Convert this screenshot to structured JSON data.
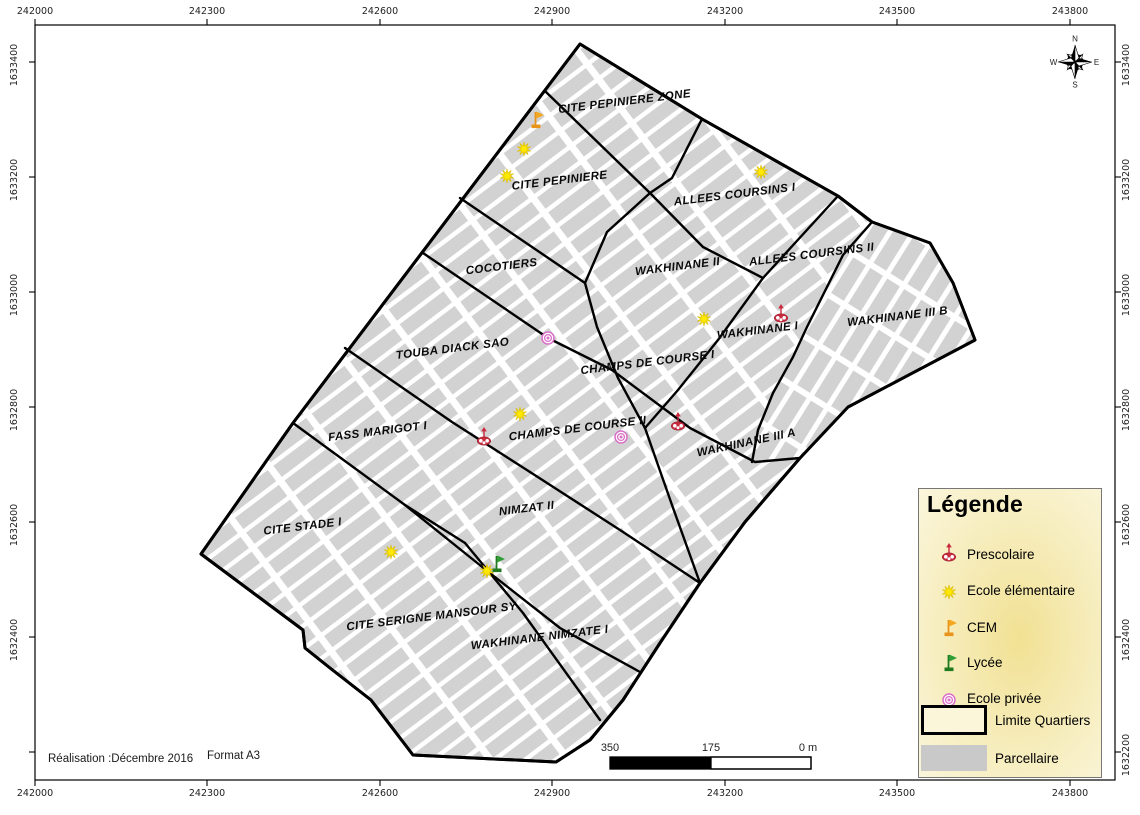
{
  "axes": {
    "top": [
      "242000",
      "242300",
      "242600",
      "242900",
      "243200",
      "243500",
      "243800"
    ],
    "bottom": [
      "242000",
      "242300",
      "242600",
      "242900",
      "243200",
      "243500",
      "243800"
    ],
    "left": [
      "1633400",
      "1633200",
      "1633000",
      "1632800",
      "1632600",
      "1632400"
    ],
    "right": [
      "1633400",
      "1633200",
      "1633000",
      "1632800",
      "1632600",
      "1632400",
      "1632200"
    ]
  },
  "regions": [
    {
      "label": "CITE PEPINIERE ZONE",
      "x": 625,
      "y": 105,
      "fs": 11.5,
      "rot": -7
    },
    {
      "label": "CITE PEPINIERE",
      "x": 560,
      "y": 184,
      "fs": 11.5,
      "rot": -7
    },
    {
      "label": "ALLEES COURSINS I",
      "x": 735,
      "y": 198,
      "fs": 11.5,
      "rot": -7
    },
    {
      "label": "ALLEES COURSINS II",
      "x": 812,
      "y": 258,
      "fs": 11.5,
      "rot": -7
    },
    {
      "label": "COCOTIERS",
      "x": 502,
      "y": 270,
      "fs": 11.5,
      "rot": -7
    },
    {
      "label": "WAKHINANE II",
      "x": 678,
      "y": 270,
      "fs": 11.5,
      "rot": -7
    },
    {
      "label": "WAKHINANE I",
      "x": 758,
      "y": 334,
      "fs": 11.5,
      "rot": -7
    },
    {
      "label": "WAKHINANE III B",
      "x": 898,
      "y": 320,
      "fs": 11.5,
      "rot": -7
    },
    {
      "label": "TOUBA DIACK SAO",
      "x": 453,
      "y": 352,
      "fs": 11.5,
      "rot": -7
    },
    {
      "label": "CHAMPS DE COURSE I",
      "x": 648,
      "y": 366,
      "fs": 11.5,
      "rot": -7
    },
    {
      "label": "CHAMPS DE COURSE II",
      "x": 578,
      "y": 432,
      "fs": 11.5,
      "rot": -7
    },
    {
      "label": "WAKHINANE III A",
      "x": 747,
      "y": 446,
      "fs": 11.5,
      "rot": -12
    },
    {
      "label": "FASS MARIGOT I",
      "x": 378,
      "y": 435,
      "fs": 11.5,
      "rot": -7
    },
    {
      "label": "NIMZAT II",
      "x": 527,
      "y": 512,
      "fs": 11.5,
      "rot": -7
    },
    {
      "label": "CITE STADE I",
      "x": 303,
      "y": 530,
      "fs": 11.5,
      "rot": -7
    },
    {
      "label": "CITE SERIGNE MANSOUR SY",
      "x": 432,
      "y": 620,
      "fs": 11.5,
      "rot": -7
    },
    {
      "label": "WAKHINANE NIMZATE I",
      "x": 540,
      "y": 641,
      "fs": 11.5,
      "rot": -7
    }
  ],
  "markers": [
    {
      "type": "cem",
      "x": 536,
      "y": 121
    },
    {
      "type": "ecole_elementaire",
      "x": 524,
      "y": 149
    },
    {
      "type": "ecole_elementaire",
      "x": 507,
      "y": 176
    },
    {
      "type": "ecole_elementaire",
      "x": 761,
      "y": 172
    },
    {
      "type": "ecole_elementaire",
      "x": 704,
      "y": 319
    },
    {
      "type": "prescolaire",
      "x": 781,
      "y": 317
    },
    {
      "type": "ecole_privee",
      "x": 548,
      "y": 338
    },
    {
      "type": "ecole_elementaire",
      "x": 520,
      "y": 414
    },
    {
      "type": "prescolaire",
      "x": 484,
      "y": 440
    },
    {
      "type": "ecole_privee",
      "x": 621,
      "y": 437
    },
    {
      "type": "prescolaire",
      "x": 678,
      "y": 425
    },
    {
      "type": "ecole_elementaire",
      "x": 391,
      "y": 552
    },
    {
      "type": "ecole_elementaire",
      "x": 487,
      "y": 571
    },
    {
      "type": "lycee",
      "x": 497,
      "y": 565
    }
  ],
  "legend": {
    "title": "Légende",
    "items": [
      {
        "id": "prescolaire",
        "label": "Prescolaire"
      },
      {
        "id": "ecole-elementaire",
        "label": "Ecole élémentaire"
      },
      {
        "id": "cem",
        "label": "CEM"
      },
      {
        "id": "lycee",
        "label": "Lycée"
      },
      {
        "id": "ecole-privee",
        "label": "Ecole privée"
      },
      {
        "id": "limite-quartiers",
        "label": "Limite Quartiers"
      },
      {
        "id": "parcellaire",
        "label": "Parcellaire"
      }
    ]
  },
  "scale_bar": {
    "left_label": "350",
    "mid_label": "175",
    "right_label": "0 m"
  },
  "compass": {
    "n": "N",
    "e": "E",
    "s": "S",
    "w": "W"
  },
  "footer": {
    "realisation": "Réalisation :Décembre 2016",
    "format": "Format A3"
  },
  "colors": {
    "parcel_gray": "#d2d2d2",
    "boundary_black": "#000000",
    "star_yellow": "#ffe900",
    "cem_orange": "#f5a81f",
    "lycee_green": "#2f9e35",
    "prescolaire_red": "#c9293d",
    "privee_pink": "#da70c8"
  }
}
